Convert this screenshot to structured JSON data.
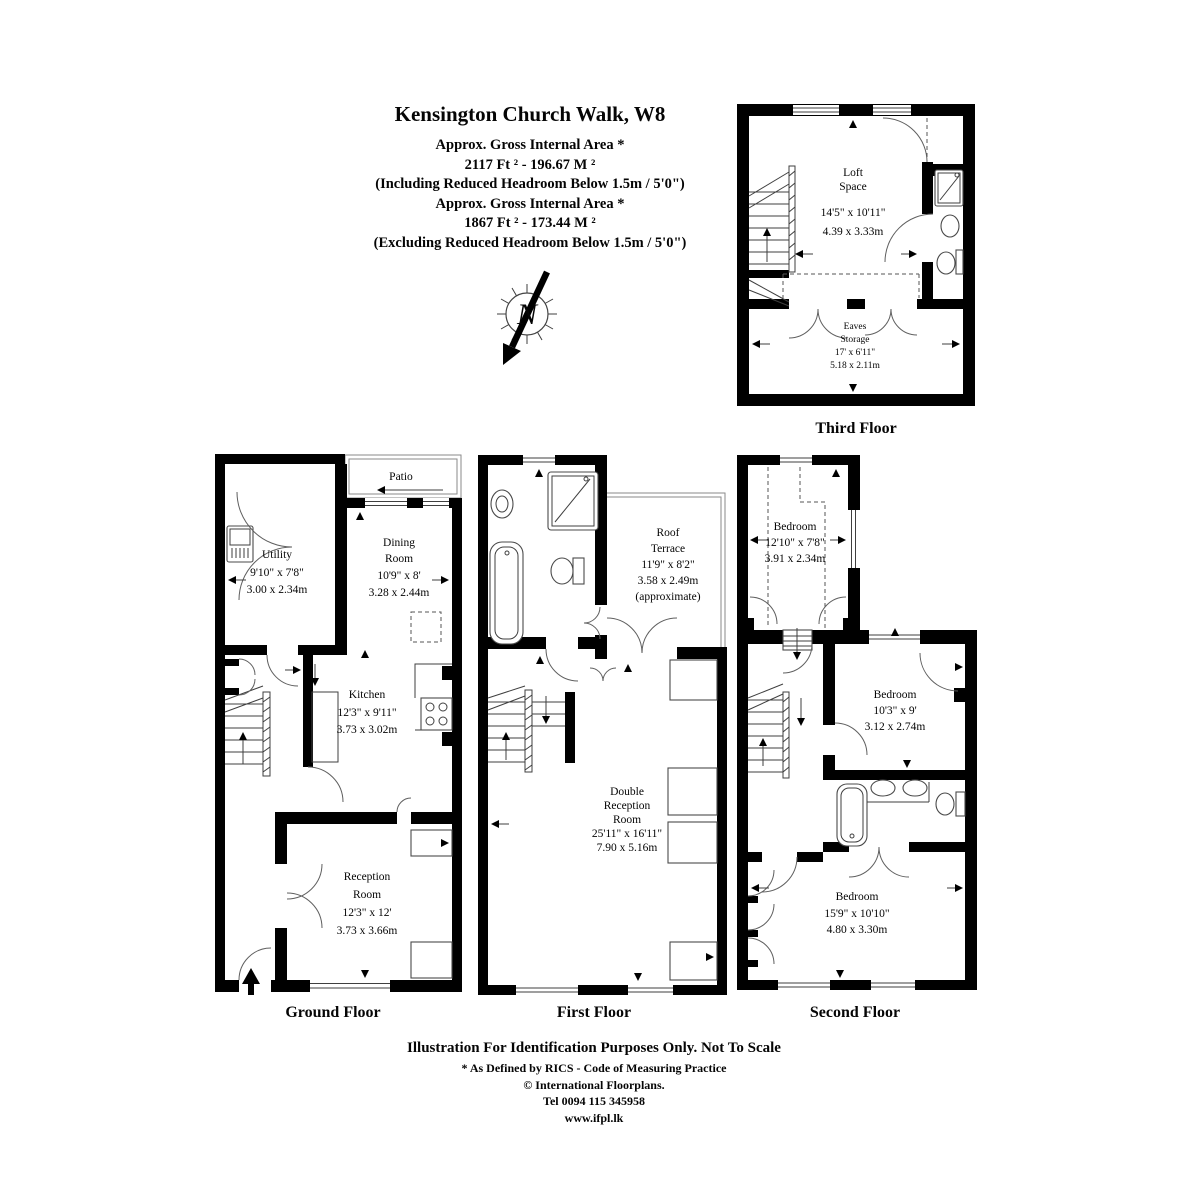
{
  "header": {
    "title": "Kensington Church Walk, W8",
    "lines": [
      "Approx. Gross Internal Area *",
      "2117 Ft ²  -  196.67 M ²",
      "(Including Reduced Headroom Below 1.5m / 5'0\")",
      "Approx. Gross Internal Area *",
      "1867 Ft ²  -  173.44 M ²",
      "(Excluding Reduced Headroom Below 1.5m / 5'0\")"
    ]
  },
  "compass": {
    "letter": "N"
  },
  "colors": {
    "wall": "#000000",
    "text": "#050505",
    "thin_line": "#3f3f3f"
  },
  "floors": {
    "third": {
      "label": "Third Floor",
      "loft": {
        "name1": "Loft",
        "name2": "Space",
        "dim_ft": "14'5\" x 10'11\"",
        "dim_m": "4.39 x 3.33m"
      },
      "eaves": {
        "name1": "Eaves",
        "name2": "Storage",
        "dim_ft": "17' x 6'11\"",
        "dim_m": "5.18 x 2.11m"
      }
    },
    "ground": {
      "label": "Ground Floor",
      "patio": "Patio",
      "utility": {
        "name1": "Utility",
        "dim_ft": "9'10\" x 7'8\"",
        "dim_m": "3.00 x 2.34m"
      },
      "dining": {
        "name1": "Dining",
        "name2": "Room",
        "dim_ft": "10'9\" x 8'",
        "dim_m": "3.28 x 2.44m"
      },
      "kitchen": {
        "name1": "Kitchen",
        "dim_ft": "12'3\" x 9'11\"",
        "dim_m": "3.73 x 3.02m"
      },
      "reception": {
        "name1": "Reception",
        "name2": "Room",
        "dim_ft": "12'3\" x 12'",
        "dim_m": "3.73 x 3.66m"
      }
    },
    "first": {
      "label": "First Floor",
      "terrace": {
        "name1": "Roof",
        "name2": "Terrace",
        "dim_ft": "11'9\" x 8'2\"",
        "dim_m": "3.58 x 2.49m",
        "note": "(approximate)"
      },
      "double_reception": {
        "name1": "Double",
        "name2": "Reception",
        "name3": "Room",
        "dim_ft": "25'11\" x 16'11\"",
        "dim_m": "7.90 x 5.16m"
      }
    },
    "second": {
      "label": "Second Floor",
      "bedroom_front": {
        "name1": "Bedroom",
        "dim_ft": "12'10\" x 7'8\"",
        "dim_m": "3.91 x 2.34m"
      },
      "bedroom_mid": {
        "name1": "Bedroom",
        "dim_ft": "10'3\" x 9'",
        "dim_m": "3.12 x 2.74m"
      },
      "bedroom_back": {
        "name1": "Bedroom",
        "dim_ft": "15'9\" x 10'10\"",
        "dim_m": "4.80 x 3.30m"
      }
    }
  },
  "footer": {
    "lines": [
      "Illustration For Identification Purposes Only. Not To Scale",
      "* As Defined by RICS - Code of Measuring Practice",
      "© International Floorplans.",
      "Tel 0094 115 345958",
      "www.ifpl.lk"
    ]
  }
}
